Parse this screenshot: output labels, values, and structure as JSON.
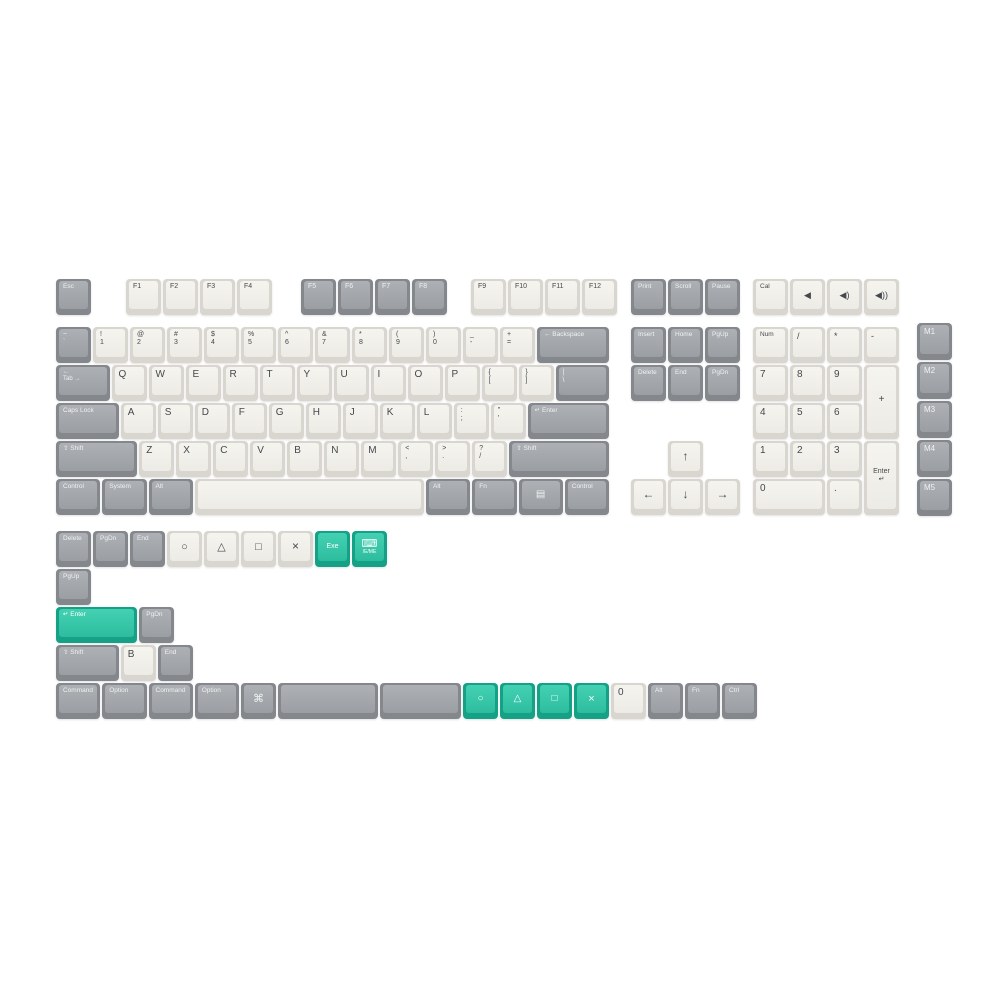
{
  "title": "Keycap set layout render",
  "colors": {
    "background": "#ffffff",
    "key_white_top": "#f2f1ec",
    "key_white_side": "#d8d6ce",
    "key_gray_top": "#a4a7ab",
    "key_gray_side": "#85888d",
    "key_teal_top": "#37c9ab",
    "key_teal_side": "#14a185",
    "legend_dark": "#45484d",
    "legend_light": "#f1f2f3"
  },
  "unit_px": 37,
  "clusters": [
    {
      "name": "function-row-main",
      "x": 55,
      "y": 278,
      "pitch": 38,
      "rows": [
        [
          {
            "n": "key-esc",
            "c": "g",
            "l": "Esc"
          },
          {
            "n": "key-f1",
            "c": "w",
            "l": "F1",
            "fs": 7,
            "gap": 33
          },
          {
            "n": "key-f2",
            "c": "w",
            "l": "F2",
            "fs": 7
          },
          {
            "n": "key-f3",
            "c": "w",
            "l": "F3",
            "fs": 7
          },
          {
            "n": "key-f4",
            "c": "w",
            "l": "F4",
            "fs": 7
          },
          {
            "n": "key-f5",
            "c": "g",
            "l": "F5",
            "fs": 7,
            "gap": 27
          },
          {
            "n": "key-f6",
            "c": "g",
            "l": "F6",
            "fs": 7
          },
          {
            "n": "key-f7",
            "c": "g",
            "l": "F7",
            "fs": 7
          },
          {
            "n": "key-f8",
            "c": "g",
            "l": "F8",
            "fs": 7
          },
          {
            "n": "key-f9",
            "c": "w",
            "l": "F9",
            "fs": 7,
            "gap": 22
          },
          {
            "n": "key-f10",
            "c": "w",
            "l": "F10",
            "fs": 7
          },
          {
            "n": "key-f11",
            "c": "w",
            "l": "F11",
            "fs": 7
          },
          {
            "n": "key-f12",
            "c": "w",
            "l": "F12",
            "fs": 7
          }
        ]
      ]
    },
    {
      "name": "function-row-nav",
      "x": 630,
      "y": 278,
      "pitch": 38,
      "rows": [
        [
          {
            "n": "key-print",
            "c": "g",
            "l": "Print"
          },
          {
            "n": "key-scroll",
            "c": "g",
            "l": "Scroll"
          },
          {
            "n": "key-pause",
            "c": "g",
            "l": "Pause"
          }
        ]
      ]
    },
    {
      "name": "function-row-media",
      "x": 752,
      "y": 278,
      "pitch": 38,
      "rows": [
        [
          {
            "n": "key-cal",
            "c": "w",
            "l": "Cal"
          },
          {
            "n": "key-mute-icon",
            "c": "w",
            "l": "◀",
            "ctr": 1,
            "fs": 9
          },
          {
            "n": "key-volume-down-icon",
            "c": "w",
            "l": "◀)",
            "ctr": 1,
            "fs": 9
          },
          {
            "n": "key-volume-up-icon",
            "c": "w",
            "l": "◀))",
            "ctr": 1,
            "fs": 9
          }
        ]
      ]
    },
    {
      "name": "main-block",
      "x": 55,
      "y": 326,
      "pitch": 38,
      "rows": [
        [
          {
            "n": "key-grave",
            "c": "g",
            "l": [
              "~",
              "`"
            ]
          },
          {
            "n": "key-1",
            "c": "w",
            "l": [
              "!",
              "1"
            ]
          },
          {
            "n": "key-2",
            "c": "w",
            "l": [
              "@",
              "2"
            ]
          },
          {
            "n": "key-3",
            "c": "w",
            "l": [
              "#",
              "3"
            ]
          },
          {
            "n": "key-4",
            "c": "w",
            "l": [
              "$",
              "4"
            ]
          },
          {
            "n": "key-5",
            "c": "w",
            "l": [
              "%",
              "5"
            ]
          },
          {
            "n": "key-6",
            "c": "w",
            "l": [
              "^",
              "6"
            ]
          },
          {
            "n": "key-7",
            "c": "w",
            "l": [
              "&",
              "7"
            ]
          },
          {
            "n": "key-8",
            "c": "w",
            "l": [
              "*",
              "8"
            ]
          },
          {
            "n": "key-9",
            "c": "w",
            "l": [
              "(",
              "9"
            ]
          },
          {
            "n": "key-0",
            "c": "w",
            "l": [
              ")",
              "0"
            ]
          },
          {
            "n": "key-minus",
            "c": "w",
            "l": [
              "_",
              "-"
            ]
          },
          {
            "n": "key-equal",
            "c": "w",
            "l": [
              "+",
              "="
            ]
          },
          {
            "n": "key-backspace",
            "c": "g",
            "w": 2,
            "l": "← Backspace"
          }
        ],
        [
          {
            "n": "key-tab",
            "c": "g",
            "w": 1.5,
            "l": [
              "←",
              "Tab →"
            ],
            "fs": 6
          },
          {
            "n": "key-q",
            "c": "w",
            "l": "Q"
          },
          {
            "n": "key-w",
            "c": "w",
            "l": "W"
          },
          {
            "n": "key-e",
            "c": "w",
            "l": "E"
          },
          {
            "n": "key-r",
            "c": "w",
            "l": "R"
          },
          {
            "n": "key-t",
            "c": "w",
            "l": "T"
          },
          {
            "n": "key-y",
            "c": "w",
            "l": "Y"
          },
          {
            "n": "key-u",
            "c": "w",
            "l": "U"
          },
          {
            "n": "key-i",
            "c": "w",
            "l": "I"
          },
          {
            "n": "key-o",
            "c": "w",
            "l": "O"
          },
          {
            "n": "key-p",
            "c": "w",
            "l": "P"
          },
          {
            "n": "key-lbracket",
            "c": "w",
            "l": [
              "{",
              "["
            ]
          },
          {
            "n": "key-rbracket",
            "c": "w",
            "l": [
              "}",
              "]"
            ]
          },
          {
            "n": "key-backslash",
            "c": "g",
            "w": 1.5,
            "l": [
              "|",
              "\\"
            ]
          }
        ],
        [
          {
            "n": "key-capslock",
            "c": "g",
            "w": 1.75,
            "l": "Caps Lock"
          },
          {
            "n": "key-a",
            "c": "w",
            "l": "A"
          },
          {
            "n": "key-s",
            "c": "w",
            "l": "S"
          },
          {
            "n": "key-d",
            "c": "w",
            "l": "D"
          },
          {
            "n": "key-f",
            "c": "w",
            "l": "F"
          },
          {
            "n": "key-g",
            "c": "w",
            "l": "G"
          },
          {
            "n": "key-h",
            "c": "w",
            "l": "H"
          },
          {
            "n": "key-j",
            "c": "w",
            "l": "J"
          },
          {
            "n": "key-k",
            "c": "w",
            "l": "K"
          },
          {
            "n": "key-l",
            "c": "w",
            "l": "L"
          },
          {
            "n": "key-semicolon",
            "c": "w",
            "l": [
              ":",
              ";"
            ]
          },
          {
            "n": "key-quote",
            "c": "w",
            "l": [
              "\"",
              "'"
            ]
          },
          {
            "n": "key-enter",
            "c": "g",
            "w": 2.25,
            "l": "↵ Enter"
          }
        ],
        [
          {
            "n": "key-lshift",
            "c": "g",
            "w": 2.25,
            "l": "⇧ Shift"
          },
          {
            "n": "key-z",
            "c": "w",
            "l": "Z"
          },
          {
            "n": "key-x",
            "c": "w",
            "l": "X"
          },
          {
            "n": "key-c",
            "c": "w",
            "l": "C"
          },
          {
            "n": "key-v",
            "c": "w",
            "l": "V"
          },
          {
            "n": "key-b",
            "c": "w",
            "l": "B"
          },
          {
            "n": "key-n",
            "c": "w",
            "l": "N"
          },
          {
            "n": "key-m",
            "c": "w",
            "l": "M"
          },
          {
            "n": "key-comma",
            "c": "w",
            "l": [
              "<",
              ","
            ]
          },
          {
            "n": "key-period",
            "c": "w",
            "l": [
              ">",
              "."
            ]
          },
          {
            "n": "key-slash",
            "c": "w",
            "l": [
              "?",
              "/"
            ]
          },
          {
            "n": "key-rshift",
            "c": "g",
            "w": 2.75,
            "l": "⇧ Shift"
          }
        ],
        [
          {
            "n": "key-lcontrol",
            "c": "g",
            "w": 1.25,
            "l": "Control"
          },
          {
            "n": "key-system",
            "c": "g",
            "w": 1.25,
            "l": "System"
          },
          {
            "n": "key-lalt",
            "c": "g",
            "w": 1.25,
            "l": "Alt"
          },
          {
            "n": "key-space",
            "c": "w",
            "w": 6.25,
            "l": ""
          },
          {
            "n": "key-ralt",
            "c": "g",
            "w": 1.25,
            "l": "Alt"
          },
          {
            "n": "key-fn",
            "c": "g",
            "w": 1.25,
            "l": "Fn",
            "fs": 6.5
          },
          {
            "n": "key-menu-icon",
            "c": "g",
            "w": 1.25,
            "l": "▤",
            "ctr": 1,
            "fs": 10
          },
          {
            "n": "key-rcontrol",
            "c": "g",
            "w": 1.25,
            "l": "Control"
          }
        ]
      ]
    },
    {
      "name": "nav-block",
      "x": 630,
      "y": 326,
      "pitch": 38,
      "rows": [
        [
          {
            "n": "key-insert",
            "c": "g",
            "l": "Insert"
          },
          {
            "n": "key-home",
            "c": "g",
            "l": "Home"
          },
          {
            "n": "key-pgup",
            "c": "g",
            "l": "PgUp"
          }
        ],
        [
          {
            "n": "key-delete",
            "c": "g",
            "l": "Delete"
          },
          {
            "n": "key-end",
            "c": "g",
            "l": "End"
          },
          {
            "n": "key-pgdn",
            "c": "g",
            "l": "PgDn"
          }
        ]
      ]
    },
    {
      "name": "arrow-block",
      "x": 630,
      "y": 440,
      "pitch": 38,
      "rows": [
        [
          {
            "sp": 1
          },
          {
            "n": "key-arrow-up-icon",
            "c": "w",
            "l": "↑",
            "ctr": 1,
            "fs": 12
          }
        ],
        [
          {
            "n": "key-arrow-left-icon",
            "c": "w",
            "l": "←",
            "ctr": 1,
            "fs": 12
          },
          {
            "n": "key-arrow-down-icon",
            "c": "w",
            "l": "↓",
            "ctr": 1,
            "fs": 12
          },
          {
            "n": "key-arrow-right-icon",
            "c": "w",
            "l": "→",
            "ctr": 1,
            "fs": 12
          }
        ]
      ]
    },
    {
      "name": "numpad-block",
      "x": 752,
      "y": 326,
      "pitch": 38,
      "rows": [
        [
          {
            "n": "key-numlock",
            "c": "w",
            "l": "Num"
          },
          {
            "n": "key-np-slash",
            "c": "w",
            "l": "/",
            "fs": 9
          },
          {
            "n": "key-np-asterisk",
            "c": "w",
            "l": "*",
            "fs": 9
          },
          {
            "n": "key-np-minus",
            "c": "w",
            "l": "-",
            "fs": 9
          }
        ],
        [
          {
            "n": "key-np-7",
            "c": "w",
            "l": "7"
          },
          {
            "n": "key-np-8",
            "c": "w",
            "l": "8"
          },
          {
            "n": "key-np-9",
            "c": "w",
            "l": "9"
          },
          {
            "n": "key-np-plus",
            "c": "w",
            "h": 2,
            "l": "+",
            "ctr": 1,
            "fs": 10
          }
        ],
        [
          {
            "n": "key-np-4",
            "c": "w",
            "l": "4"
          },
          {
            "n": "key-np-5",
            "c": "w",
            "l": "5"
          },
          {
            "n": "key-np-6",
            "c": "w",
            "l": "6"
          },
          {
            "sp": 1
          }
        ],
        [
          {
            "n": "key-np-1",
            "c": "w",
            "l": "1"
          },
          {
            "n": "key-np-2",
            "c": "w",
            "l": "2"
          },
          {
            "n": "key-np-3",
            "c": "w",
            "l": "3"
          },
          {
            "n": "key-np-enter",
            "c": "w",
            "h": 2,
            "l": [
              "Enter",
              "↵"
            ],
            "ctr": 1,
            "fs": 7
          }
        ],
        [
          {
            "n": "key-np-0",
            "c": "w",
            "w": 2,
            "l": "0"
          },
          {
            "n": "key-np-dot",
            "c": "w",
            "l": "."
          },
          {
            "sp": 1
          }
        ]
      ]
    },
    {
      "name": "macro-column",
      "x": 916,
      "y": 322,
      "pitch": 39,
      "rows": [
        [
          {
            "n": "key-m1",
            "c": "g",
            "l": "M1",
            "fs": 8
          }
        ],
        [
          {
            "n": "key-m2",
            "c": "g",
            "l": "M2",
            "fs": 8
          }
        ],
        [
          {
            "n": "key-m3",
            "c": "g",
            "l": "M3",
            "fs": 8
          }
        ],
        [
          {
            "n": "key-m4",
            "c": "g",
            "l": "M4",
            "fs": 8
          }
        ],
        [
          {
            "n": "key-m5",
            "c": "g",
            "l": "M5",
            "fs": 8
          }
        ]
      ]
    },
    {
      "name": "extras-block",
      "x": 55,
      "y": 530,
      "pitch": 38,
      "rows": [
        [
          {
            "n": "key-extra-delete",
            "c": "g",
            "l": "Delete"
          },
          {
            "n": "key-extra-pgdn",
            "c": "g",
            "l": "PgDn"
          },
          {
            "n": "key-extra-end",
            "c": "g",
            "l": "End"
          },
          {
            "n": "key-circle-icon",
            "c": "w",
            "l": "○",
            "ctr": 1,
            "fs": 11
          },
          {
            "n": "key-triangle-icon",
            "c": "w",
            "l": "△",
            "ctr": 1,
            "fs": 11
          },
          {
            "n": "key-square-icon",
            "c": "w",
            "l": "□",
            "ctr": 1,
            "fs": 11
          },
          {
            "n": "key-cross-icon",
            "c": "w",
            "l": "×",
            "ctr": 1,
            "fs": 12
          },
          {
            "n": "key-exe",
            "c": "t",
            "l": "Exe",
            "ctr": 1,
            "fs": 7
          },
          {
            "n": "key-keyboard-novelty-icon",
            "c": "t",
            "l": [
              "⌨",
              "/E/ME"
            ],
            "ctr": 1,
            "fs": 5,
            "kbd": 1
          }
        ],
        [
          {
            "n": "key-extra-pgup",
            "c": "g",
            "l": "PgUp"
          }
        ],
        [
          {
            "n": "key-extra-enter-teal",
            "c": "t",
            "w": 2.25,
            "l": "↵ Enter"
          },
          {
            "n": "key-extra-pgdn-2",
            "c": "g",
            "l": "PgDn"
          }
        ],
        [
          {
            "n": "key-extra-shift",
            "c": "g",
            "w": 1.75,
            "l": "⇧ Shift"
          },
          {
            "n": "key-extra-b",
            "c": "w",
            "l": "B"
          },
          {
            "n": "key-extra-end-2",
            "c": "g",
            "l": "End"
          }
        ],
        [
          {
            "n": "key-command-1",
            "c": "g",
            "w": 1.25,
            "l": "Command"
          },
          {
            "n": "key-option-1",
            "c": "g",
            "w": 1.25,
            "l": "Option"
          },
          {
            "n": "key-command-2",
            "c": "g",
            "w": 1.25,
            "l": "Command"
          },
          {
            "n": "key-option-2",
            "c": "g",
            "w": 1.25,
            "l": "Option"
          },
          {
            "n": "key-cmd-symbol-icon",
            "c": "g",
            "l": "⌘",
            "ctr": 1,
            "fs": 11
          },
          {
            "n": "key-space-gray-1",
            "c": "g",
            "w": 2.75,
            "l": ""
          },
          {
            "n": "key-space-gray-2",
            "c": "g",
            "w": 2.25,
            "l": ""
          },
          {
            "n": "key-circle-teal-icon",
            "c": "t",
            "l": "○",
            "ctr": 1,
            "fs": 10
          },
          {
            "n": "key-triangle-teal-icon",
            "c": "t",
            "l": "△",
            "ctr": 1,
            "fs": 10
          },
          {
            "n": "key-square-teal-icon",
            "c": "t",
            "l": "□",
            "ctr": 1,
            "fs": 10
          },
          {
            "n": "key-cross-teal-icon",
            "c": "t",
            "l": "×",
            "ctr": 1,
            "fs": 11
          },
          {
            "n": "key-extra-0",
            "c": "w",
            "l": "0"
          },
          {
            "n": "key-extra-alt",
            "c": "g",
            "l": "Alt"
          },
          {
            "n": "key-extra-fn",
            "c": "g",
            "l": "Fn",
            "fs": 6.5
          },
          {
            "n": "key-extra-ctrl",
            "c": "g",
            "l": "Ctrl"
          }
        ]
      ]
    }
  ]
}
